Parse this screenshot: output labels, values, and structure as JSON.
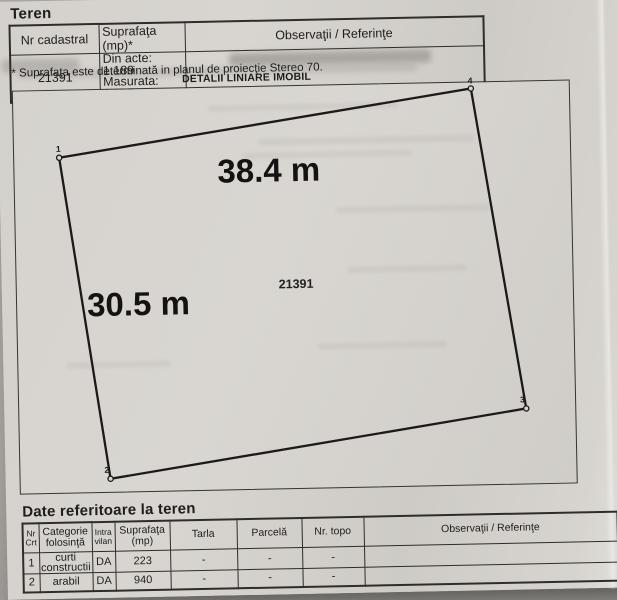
{
  "teren": {
    "title": "Teren",
    "headers": {
      "nr_cadastral": "Nr cadastral",
      "suprafata": "Suprafaţa (mp)*",
      "observatii": "Observaţii / Referinţe"
    },
    "values": {
      "nr_cadastral": "21391",
      "din_acte": "Din acte: 1.189",
      "masurata": "Masurata: 1.163",
      "observatii": ""
    },
    "footnote": "* Suprafaţa este determinată in planul de proiecţie Stereo 70."
  },
  "diagram": {
    "title": "DETALII LINIARE IMOBIL",
    "top_length_label": "38.4 m",
    "left_length_label": "30.5 m",
    "parcel_number": "21391",
    "corner_labels": {
      "top_left": "1",
      "top_right": "4",
      "bottom_right": "3",
      "bottom_left": "2"
    }
  },
  "date_teren": {
    "title": "Date referitoare la teren",
    "headers": [
      "Nr Crt",
      "Categorie folosinţă",
      "Intra vilan",
      "Suprafaţa (mp)",
      "Tarla",
      "Parcelă",
      "Nr. topo",
      "Observaţii / Referinţe"
    ],
    "rows": [
      {
        "nr": "1",
        "categorie": "curti constructii",
        "intravilan": "DA",
        "suprafata": "223",
        "tarla": "-",
        "parcela": "-",
        "nr_topo": "-",
        "observatii": ""
      },
      {
        "nr": "2",
        "categorie": "arabil",
        "intravilan": "DA",
        "suprafata": "940",
        "tarla": "-",
        "parcela": "-",
        "nr_topo": "-",
        "observatii": ""
      }
    ]
  }
}
